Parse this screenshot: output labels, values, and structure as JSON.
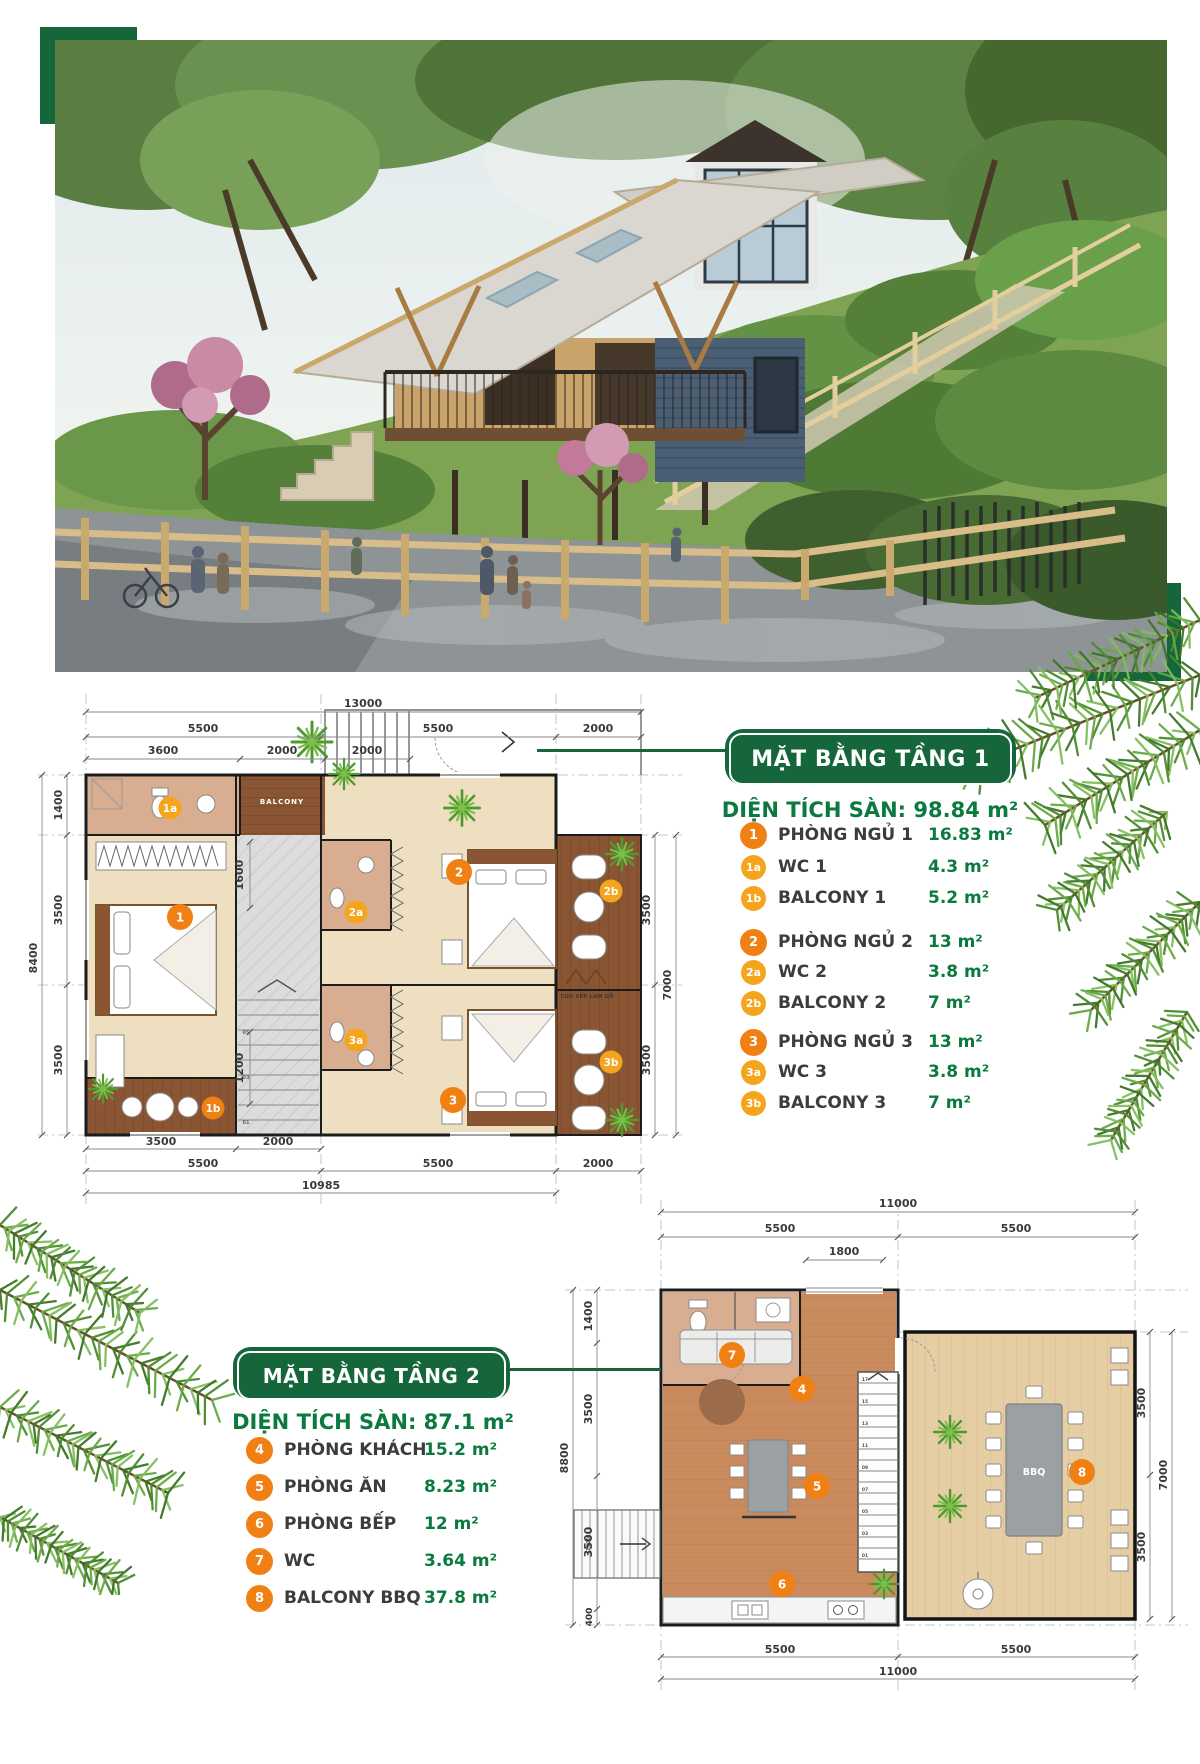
{
  "colors": {
    "brand_green": "#15663A",
    "value_green": "#0A7A3F",
    "badge_orange": "#F08014",
    "badge_light_orange": "#F5A51D"
  },
  "plan1": {
    "banner": "MẶT BẰNG TẦNG 1",
    "area_label": "DIỆN TÍCH SÀN:",
    "area_value": "98.84 m²",
    "legend": [
      {
        "badge": "1",
        "label": "PHÒNG NGỦ 1",
        "value": "16.83 m²"
      },
      {
        "badge": "1a",
        "label": "WC 1",
        "value": "4.3 m²"
      },
      {
        "badge": "1b",
        "label": "BALCONY 1",
        "value": "5.2 m²"
      },
      {
        "badge": "2",
        "label": "PHÒNG NGỦ 2",
        "value": "13 m²"
      },
      {
        "badge": "2a",
        "label": "WC 2",
        "value": "3.8 m²"
      },
      {
        "badge": "2b",
        "label": "BALCONY 2",
        "value": "7 m²"
      },
      {
        "badge": "3",
        "label": "PHÒNG NGỦ 3",
        "value": "13 m²"
      },
      {
        "badge": "3a",
        "label": "WC 3",
        "value": "3.8 m²"
      },
      {
        "badge": "3b",
        "label": "BALCONY 3",
        "value": "7 m²"
      }
    ],
    "badges": [
      "1",
      "1a",
      "1b",
      "2",
      "2a",
      "2b",
      "3",
      "3a",
      "3b"
    ],
    "dims": {
      "w_total": "13000",
      "w1": "5500",
      "w2": "5500",
      "w3": "2000",
      "s1": "3600",
      "s2": "2000",
      "s3": "2000",
      "l1": "1400",
      "l2": "3500",
      "l3": "3500",
      "l_total": "8400",
      "r1": "3500",
      "r2": "3500",
      "r_total": "7000",
      "b1": "3500",
      "b2": "2000",
      "bw1": "5500",
      "bw2": "5500",
      "bw3": "2000",
      "b_total": "10985",
      "i1": "1600",
      "i2": "1200"
    },
    "labels": {
      "balcony": "BALCONY",
      "door": "CỬA XẾP LAM GỖ"
    },
    "stairs": [
      "05",
      "03",
      "01"
    ]
  },
  "plan2": {
    "banner": "MẶT BẰNG TẦNG 2",
    "area_label": "DIỆN TÍCH SÀN:",
    "area_value": "87.1 m²",
    "legend": [
      {
        "badge": "4",
        "label": "PHÒNG KHÁCH",
        "value": "15.2 m²"
      },
      {
        "badge": "5",
        "label": "PHÒNG ĂN",
        "value": "8.23 m²"
      },
      {
        "badge": "6",
        "label": "PHÒNG BẾP",
        "value": "12 m²"
      },
      {
        "badge": "7",
        "label": "WC",
        "value": "3.64 m²"
      },
      {
        "badge": "8",
        "label": "BALCONY BBQ",
        "value": "37.8 m²"
      }
    ],
    "badges": [
      "4",
      "5",
      "6",
      "7",
      "8"
    ],
    "dims": {
      "w_total": "11000",
      "w1": "5500",
      "w2": "5500",
      "s1": "1800",
      "l1": "1400",
      "l2": "3500",
      "l3": "3500",
      "l4": "400",
      "l_total": "8800",
      "r1": "3500",
      "r2": "3500",
      "r_total": "7000",
      "b1": "5500",
      "b2": "5500",
      "b_total": "11000",
      "i1": "1400"
    },
    "labels": {
      "bbq": "BBQ"
    },
    "stairs": [
      "17",
      "15",
      "13",
      "11",
      "09",
      "07",
      "05",
      "03",
      "01"
    ]
  }
}
